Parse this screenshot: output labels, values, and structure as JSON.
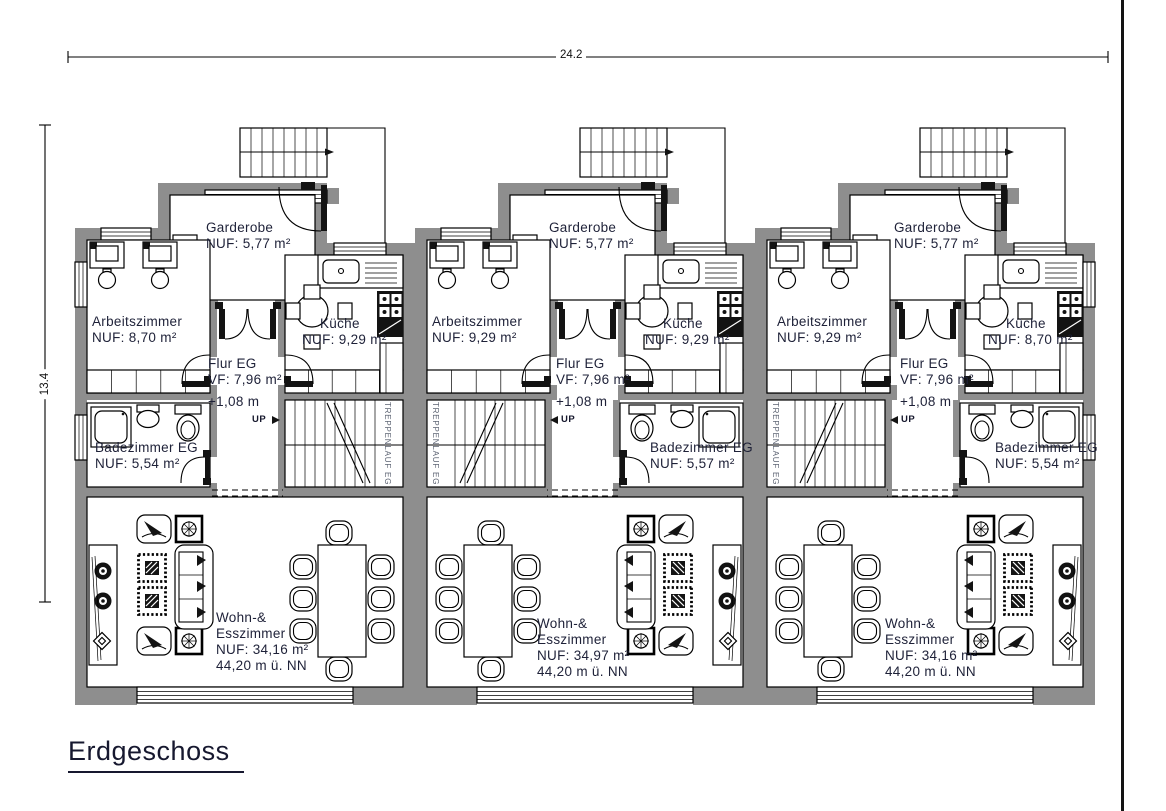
{
  "title": "Erdgeschoss",
  "dimensions": {
    "width": "24.2",
    "height": "13.4"
  },
  "common": {
    "stairwell": "TREPPENLAUF EG",
    "up": "UP"
  },
  "units": [
    {
      "name": "unit-1",
      "garderobe_name": "Garderobe",
      "garderobe_area": "NUF: 5,77 m²",
      "arbeitszimmer_name": "Arbeitszimmer",
      "arbeitszimmer_area": "NUF: 8,70 m²",
      "kueche_name": "Küche",
      "kueche_area": "NUF: 9,29 m²",
      "flur_name": "Flur EG",
      "flur_area": "VF: 7,96 m²",
      "flur_level": "+1,08 m",
      "bad_name": "Badezimmer EG",
      "bad_area": "NUF: 5,54 m²",
      "wohn_name1": "Wohn-&",
      "wohn_name2": "Esszimmer",
      "wohn_area": "NUF:  34,16 m²",
      "wohn_elevation": "44,20 m ü. NN"
    },
    {
      "name": "unit-2",
      "garderobe_name": "Garderobe",
      "garderobe_area": "NUF: 5,77 m²",
      "arbeitszimmer_name": "Arbeitszimmer",
      "arbeitszimmer_area": "NUF: 9,29 m²",
      "kueche_name": "Küche",
      "kueche_area": "NUF: 9,29 m²",
      "flur_name": "Flur EG",
      "flur_area": "VF: 7,96 m²",
      "flur_level": "+1,08 m",
      "bad_name": "Badezimmer EG",
      "bad_area": "NUF: 5,57 m²",
      "wohn_name1": "Wohn-&",
      "wohn_name2": "Esszimmer",
      "wohn_area": "NUF:  34,97 m²",
      "wohn_elevation": "44,20 m ü. NN"
    },
    {
      "name": "unit-3",
      "garderobe_name": "Garderobe",
      "garderobe_area": "NUF: 5,77 m²",
      "arbeitszimmer_name": "Arbeitszimmer",
      "arbeitszimmer_area": "NUF: 9,29 m²",
      "kueche_name": "Küche",
      "kueche_area": "NUF: 8,70 m²",
      "flur_name": "Flur EG",
      "flur_area": "VF: 7,96 m²",
      "flur_level": "+1,08 m",
      "bad_name": "Badezimmer EG",
      "bad_area": "NUF: 5,54 m²",
      "wohn_name1": "Wohn-&",
      "wohn_name2": "Esszimmer",
      "wohn_area": "NUF:  34,16 m²",
      "wohn_elevation": "44,20 m ü. NN"
    }
  ],
  "colors": {
    "wall": "#8e8e8e",
    "text": "#1e2138",
    "stair_text": "#5e6574"
  }
}
